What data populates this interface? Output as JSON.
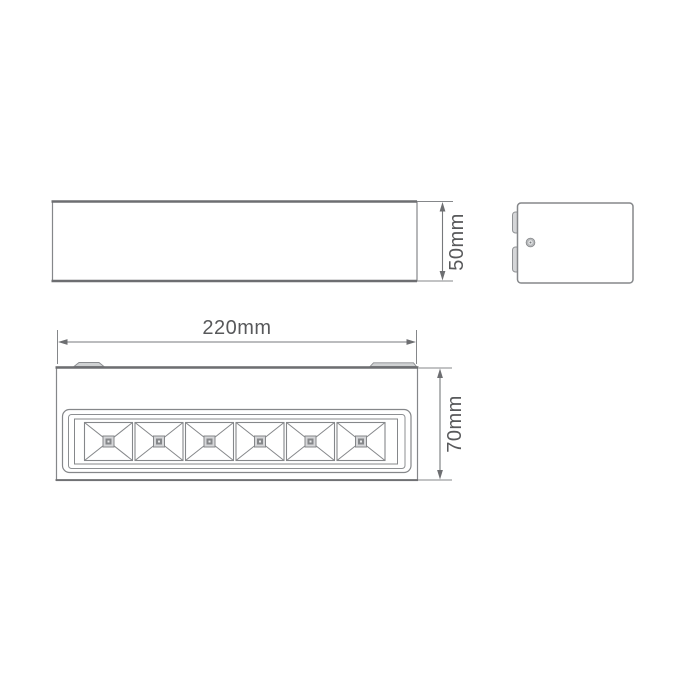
{
  "page": {
    "type": "product-dimension-diagram",
    "background": "#ffffff"
  },
  "labels": {
    "side_height": "50mm",
    "body_width": "220mm",
    "body_height": "70mm"
  },
  "colors": {
    "line": "#85878a",
    "line_dark": "#6d6e71",
    "fill_light": "#d5d6d8",
    "fill_mid": "#b6b8ba",
    "text": "#58595b",
    "background": "#ffffff"
  },
  "views": {
    "top_view": {
      "kind": "top-profile-outline"
    },
    "side_view": {
      "kind": "end-profile",
      "screw_count": 1,
      "clip_tab_count": 2
    },
    "front_view": {
      "kind": "front-face",
      "led_cell_count": 6,
      "mounting_tab_count": 2
    }
  }
}
